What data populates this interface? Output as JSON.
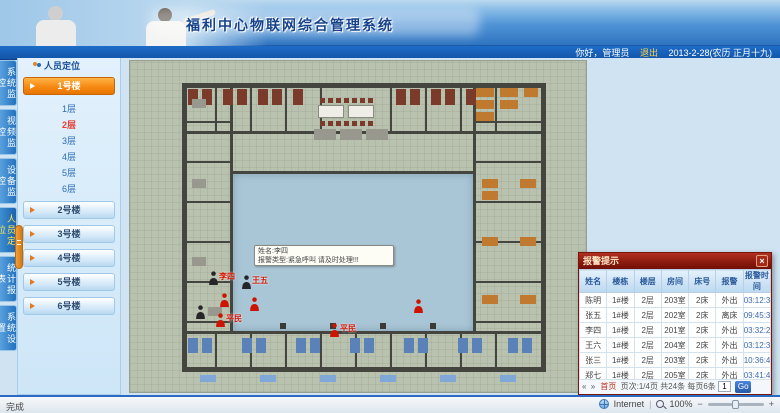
{
  "header": {
    "title": "福利中心物联网综合管理系统",
    "greeting": "你好，管理员",
    "logout": "退出",
    "date": "2013-2-28(农历 正月十九)"
  },
  "nav_tabs": [
    {
      "label": "系统监控",
      "active": false
    },
    {
      "label": "视频监控",
      "active": false
    },
    {
      "label": "设备监控",
      "active": false
    },
    {
      "label": "人员定位",
      "active": true
    },
    {
      "label": "统计报表",
      "active": false
    },
    {
      "label": "系统设置",
      "active": false
    }
  ],
  "sidebar": {
    "panel_title": "人员定位",
    "buildings": [
      {
        "label": "1号楼",
        "expanded": true,
        "floors": [
          {
            "label": "1层",
            "active": false
          },
          {
            "label": "2层",
            "active": true
          },
          {
            "label": "3层",
            "active": false
          },
          {
            "label": "4层",
            "active": false
          },
          {
            "label": "5层",
            "active": false
          },
          {
            "label": "6层",
            "active": false
          }
        ]
      },
      {
        "label": "2号楼",
        "expanded": false
      },
      {
        "label": "3号楼",
        "expanded": false
      },
      {
        "label": "4号楼",
        "expanded": false
      },
      {
        "label": "5号楼",
        "expanded": false
      },
      {
        "label": "6号楼",
        "expanded": false
      }
    ]
  },
  "map": {
    "tooltip": {
      "line1": "姓名:李四",
      "line2": "报警类型:紧急呼叫 请及时处理!!!"
    },
    "walls": [
      [
        52,
        22,
        364,
        5
      ],
      [
        52,
        306,
        364,
        5
      ],
      [
        52,
        22,
        5,
        289
      ],
      [
        411,
        22,
        5,
        289
      ],
      [
        52,
        70,
        364,
        3
      ],
      [
        52,
        270,
        364,
        3
      ],
      [
        100,
        110,
        246,
        3
      ],
      [
        100,
        22,
        3,
        251
      ],
      [
        343,
        22,
        3,
        251
      ],
      [
        85,
        27,
        2,
        43
      ],
      [
        120,
        27,
        2,
        43
      ],
      [
        155,
        27,
        2,
        43
      ],
      [
        190,
        27,
        2,
        43
      ],
      [
        260,
        27,
        2,
        43
      ],
      [
        295,
        27,
        2,
        43
      ],
      [
        330,
        27,
        2,
        43
      ],
      [
        365,
        27,
        2,
        43
      ],
      [
        85,
        273,
        2,
        33
      ],
      [
        120,
        273,
        2,
        33
      ],
      [
        155,
        273,
        2,
        33
      ],
      [
        190,
        273,
        2,
        33
      ],
      [
        225,
        273,
        2,
        33
      ],
      [
        260,
        273,
        2,
        33
      ],
      [
        295,
        273,
        2,
        33
      ],
      [
        330,
        273,
        2,
        33
      ],
      [
        365,
        273,
        2,
        33
      ],
      [
        52,
        60,
        48,
        2
      ],
      [
        52,
        100,
        48,
        2
      ],
      [
        52,
        140,
        48,
        2
      ],
      [
        52,
        180,
        48,
        2
      ],
      [
        52,
        220,
        48,
        2
      ],
      [
        52,
        260,
        48,
        2
      ],
      [
        346,
        60,
        65,
        2
      ],
      [
        346,
        100,
        65,
        2
      ],
      [
        346,
        140,
        65,
        2
      ],
      [
        346,
        180,
        65,
        2
      ],
      [
        346,
        220,
        65,
        2
      ],
      [
        346,
        260,
        65,
        2
      ]
    ],
    "furniture": [
      [
        58,
        28,
        10,
        16,
        "#7a3b2a"
      ],
      [
        72,
        28,
        10,
        16,
        "#7a3b2a"
      ],
      [
        93,
        28,
        10,
        16,
        "#7a3b2a"
      ],
      [
        107,
        28,
        10,
        16,
        "#7a3b2a"
      ],
      [
        128,
        28,
        10,
        16,
        "#7a3b2a"
      ],
      [
        142,
        28,
        10,
        16,
        "#7a3b2a"
      ],
      [
        163,
        28,
        10,
        16,
        "#7a3b2a"
      ],
      [
        266,
        28,
        10,
        16,
        "#7a3b2a"
      ],
      [
        280,
        28,
        10,
        16,
        "#7a3b2a"
      ],
      [
        301,
        28,
        10,
        16,
        "#7a3b2a"
      ],
      [
        315,
        28,
        10,
        16,
        "#7a3b2a"
      ],
      [
        336,
        28,
        10,
        16,
        "#7a3b2a"
      ],
      [
        346,
        27,
        18,
        9,
        "#c07a30"
      ],
      [
        346,
        39,
        18,
        9,
        "#c07a30"
      ],
      [
        346,
        51,
        18,
        9,
        "#c07a30"
      ],
      [
        370,
        27,
        18,
        9,
        "#c07a30"
      ],
      [
        370,
        39,
        18,
        9,
        "#c07a30"
      ],
      [
        394,
        27,
        14,
        9,
        "#c07a30"
      ],
      [
        188,
        44,
        26,
        13,
        "white"
      ],
      [
        218,
        44,
        26,
        13,
        "white"
      ],
      [
        190,
        37,
        5,
        5,
        "#7a3b2a"
      ],
      [
        198,
        37,
        5,
        5,
        "#7a3b2a"
      ],
      [
        206,
        37,
        5,
        5,
        "#7a3b2a"
      ],
      [
        214,
        37,
        5,
        5,
        "#7a3b2a"
      ],
      [
        222,
        37,
        5,
        5,
        "#7a3b2a"
      ],
      [
        230,
        37,
        5,
        5,
        "#7a3b2a"
      ],
      [
        238,
        37,
        5,
        5,
        "#7a3b2a"
      ],
      [
        190,
        60,
        5,
        5,
        "#7a3b2a"
      ],
      [
        198,
        60,
        5,
        5,
        "#7a3b2a"
      ],
      [
        206,
        60,
        5,
        5,
        "#7a3b2a"
      ],
      [
        214,
        60,
        5,
        5,
        "#7a3b2a"
      ],
      [
        222,
        60,
        5,
        5,
        "#7a3b2a"
      ],
      [
        230,
        60,
        5,
        5,
        "#7a3b2a"
      ],
      [
        238,
        60,
        5,
        5,
        "#7a3b2a"
      ],
      [
        184,
        68,
        22,
        11,
        "#98988e"
      ],
      [
        210,
        68,
        22,
        11,
        "#98988e"
      ],
      [
        236,
        68,
        22,
        11,
        "#98988e"
      ],
      [
        352,
        118,
        16,
        9,
        "#c07a30"
      ],
      [
        352,
        130,
        16,
        9,
        "#c07a30"
      ],
      [
        390,
        118,
        16,
        9,
        "#c07a30"
      ],
      [
        352,
        176,
        16,
        9,
        "#c07a30"
      ],
      [
        390,
        176,
        16,
        9,
        "#c07a30"
      ],
      [
        352,
        234,
        16,
        9,
        "#c07a30"
      ],
      [
        390,
        234,
        16,
        9,
        "#c07a30"
      ],
      [
        62,
        38,
        14,
        9,
        "#98988e"
      ],
      [
        62,
        118,
        14,
        9,
        "#98988e"
      ],
      [
        62,
        196,
        14,
        9,
        "#98988e"
      ],
      [
        78,
        246,
        14,
        9,
        "#98988e"
      ],
      [
        58,
        277,
        10,
        15,
        "#5b82b8"
      ],
      [
        72,
        277,
        10,
        15,
        "#5b82b8"
      ],
      [
        112,
        277,
        10,
        15,
        "#5b82b8"
      ],
      [
        126,
        277,
        10,
        15,
        "#5b82b8"
      ],
      [
        166,
        277,
        10,
        15,
        "#5b82b8"
      ],
      [
        180,
        277,
        10,
        15,
        "#5b82b8"
      ],
      [
        220,
        277,
        10,
        15,
        "#5b82b8"
      ],
      [
        234,
        277,
        10,
        15,
        "#5b82b8"
      ],
      [
        274,
        277,
        10,
        15,
        "#5b82b8"
      ],
      [
        288,
        277,
        10,
        15,
        "#5b82b8"
      ],
      [
        328,
        277,
        10,
        15,
        "#5b82b8"
      ],
      [
        342,
        277,
        10,
        15,
        "#5b82b8"
      ],
      [
        378,
        277,
        10,
        15,
        "#5b82b8"
      ],
      [
        392,
        277,
        10,
        15,
        "#5b82b8"
      ],
      [
        70,
        314,
        16,
        7,
        "#7fa8d8"
      ],
      [
        130,
        314,
        16,
        7,
        "#7fa8d8"
      ],
      [
        190,
        314,
        16,
        7,
        "#7fa8d8"
      ],
      [
        250,
        314,
        16,
        7,
        "#7fa8d8"
      ],
      [
        310,
        314,
        16,
        7,
        "#7fa8d8"
      ],
      [
        370,
        314,
        16,
        7,
        "#7fa8d8"
      ],
      [
        150,
        262,
        6,
        6,
        "#3a3a36"
      ],
      [
        200,
        262,
        6,
        6,
        "#3a3a36"
      ],
      [
        250,
        262,
        6,
        6,
        "#3a3a36"
      ],
      [
        300,
        262,
        6,
        6,
        "#3a3a36"
      ]
    ],
    "markers": [
      {
        "x": 77,
        "y": 210,
        "color": "black",
        "label": "李四"
      },
      {
        "x": 110,
        "y": 214,
        "color": "black",
        "label": "王五"
      },
      {
        "x": 88,
        "y": 232,
        "color": "red",
        "label": ""
      },
      {
        "x": 118,
        "y": 236,
        "color": "red",
        "label": ""
      },
      {
        "x": 64,
        "y": 244,
        "color": "black",
        "label": ""
      },
      {
        "x": 84,
        "y": 252,
        "color": "red",
        "label": "平民"
      },
      {
        "x": 198,
        "y": 262,
        "color": "red",
        "label": "平民"
      },
      {
        "x": 282,
        "y": 238,
        "color": "red",
        "label": ""
      }
    ]
  },
  "alarm_popup": {
    "title": "报警提示",
    "close": "×",
    "columns": [
      "姓名",
      "楼栋",
      "楼层",
      "房间",
      "床号",
      "报警",
      "报警时间"
    ],
    "rows": [
      [
        "陈明",
        "1#楼",
        "2层",
        "203室",
        "2床",
        "外出",
        "03:12:38"
      ],
      [
        "张五",
        "1#楼",
        "2层",
        "202室",
        "2床",
        "离床",
        "09:45:34"
      ],
      [
        "李四",
        "1#楼",
        "2层",
        "201室",
        "2床",
        "外出",
        "03:32:25"
      ],
      [
        "王六",
        "1#楼",
        "2层",
        "204室",
        "2床",
        "外出",
        "03:12:38"
      ],
      [
        "张三",
        "1#楼",
        "2层",
        "203室",
        "2床",
        "外出",
        "10:36:47"
      ],
      [
        "郑七",
        "1#楼",
        "2层",
        "205室",
        "2床",
        "外出",
        "03:41:46"
      ]
    ],
    "pagination": {
      "prev": "«",
      "next": "»",
      "first": "首页",
      "info1": "页次:1/4页",
      "info2": "共24条",
      "info3": "每页6条",
      "goto_value": "1",
      "go": "Go"
    }
  },
  "status_bar": {
    "left": "完成",
    "zone": "Internet",
    "zoom": "100%",
    "minus": "−",
    "plus": "+"
  }
}
